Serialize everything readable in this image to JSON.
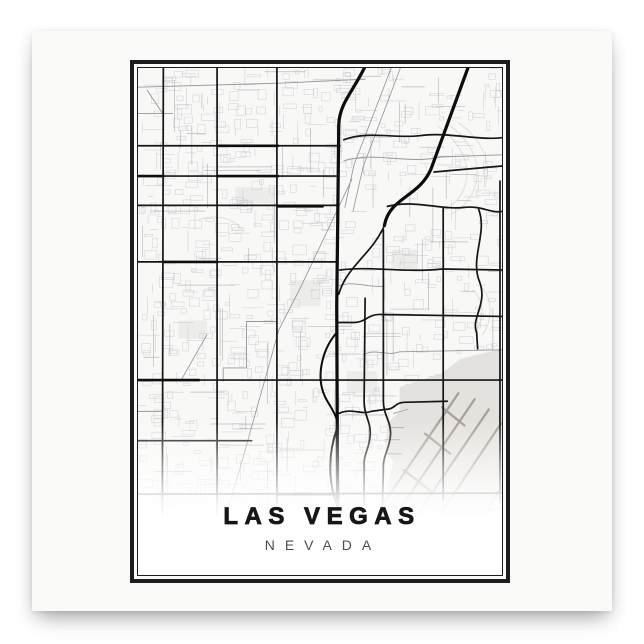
{
  "poster": {
    "title": "LAS VEGAS",
    "subtitle": "NEVADA",
    "colors": {
      "page_background": "#ffffff",
      "sheet": "#fafaf9",
      "frame": "#1d1d1f",
      "map_background": "#f8f8f6",
      "title": "#171717",
      "subtitle": "#4e4e4e",
      "road_major": "#161616",
      "road_freeway": "#0d0d0d",
      "road_medium": "#97979b",
      "road_fine": "#cdcdd1",
      "railway": "#8d8d91",
      "contour": "#d9d9d5",
      "airport_field": "#e4e2de",
      "airport_runway": "#a89f97",
      "airport_detail": "#b5afa8",
      "block_patch": "#ececea",
      "fade": "#ffffff"
    }
  },
  "map": {
    "viewbox": "0 0 359 502",
    "texture": {
      "seed": 11,
      "rect_count": 560,
      "segment_count": 300,
      "medium_segment_count": 90,
      "fine_color": "#cdcdd1",
      "medium_color": "#a7a7ac",
      "area": [
        0,
        0,
        356,
        436
      ]
    },
    "layers": [
      {
        "id": "contours",
        "stroke": "#d9d9d5",
        "width": 0.8,
        "paths": [
          "M296,58 C318,74 330,96 322,118 C318,130 308,138 300,142",
          "M306,56 C328,72 340,94 332,118 C328,131 318,140 310,144",
          "M316,54 C338,70 350,92 342,118",
          "M330,220 C344,232 340,252 332,262",
          "M338,216 C352,230 348,252 340,264",
          "M60,150 C80,144 96,150 104,162"
        ]
      },
      {
        "id": "block-patches",
        "fill": "#ececea",
        "paths": [
          "M96,118 h38 v16 h-38 Z",
          "M150,210 h30 v26 h-30 Z",
          "M250,180 h26 v20 h-26 Z",
          "M40,250 h28 v18 h-28 Z",
          "M206,300 h30 v22 h-30 Z"
        ]
      },
      {
        "id": "street-texture",
        "generate": true
      },
      {
        "id": "airport-field",
        "fill": "#e4e2de",
        "paths": [
          "M246,352 L258,340 L258,316 L300,302 L318,288 L359,278 L359,474 L268,474 L250,446 L246,414 L252,390 L244,378 Z"
        ]
      },
      {
        "id": "airport-runways",
        "stroke": "#a89f97",
        "width": 2.2,
        "paths": [
          "M252,446 L332,328",
          "M266,456 L346,338",
          "M282,466 L358,352",
          "M243,430 L316,322",
          "M300,336 L322,354",
          "M283,362 L308,382",
          "M262,398 L290,420",
          "M250,432 L276,452",
          "M244,452 L359,436",
          "M322,472 L359,414"
        ]
      },
      {
        "id": "airport-detail",
        "stroke": "#b5afa8",
        "width": 1.1,
        "paths": [
          "M248,356 L262,356",
          "M244,368 L258,368",
          "M246,382 L260,382",
          "M252,342 L266,338"
        ]
      },
      {
        "id": "railways",
        "stroke": "#8d8d91",
        "width": 0.75,
        "paths": [
          "M252,-6 L213,96 L204,138",
          "M261,-6 L222,98 L212,142",
          "M211,110 L160,218 L139,259 L99,402 L89,434",
          "M68,264 L42,310"
        ]
      },
      {
        "id": "medium-roads",
        "stroke": "#97979b",
        "width": 0.9,
        "paths": [
          "M0,19 L140,15 L224,11",
          "M0,45 L34,45",
          "M9,22 L25,46",
          "M203,92 C235,82 262,96 300,88 L359,86",
          "M197,216 C212,210 228,218 242,216",
          "M222,284 C235,277 245,286 258,281 L359,279",
          "M0,340 L24,340",
          "M241,430 L241,466",
          "M224,430 L224,462",
          "M137,251 L107,251 L107,297 L84,297 L84,310"
        ]
      },
      {
        "id": "major-roads",
        "stroke": "#161616",
        "width": 1.7,
        "paths": [
          "M25,-4 L24,450",
          "M78,-4 L78,450",
          "M137,-4 L137,432",
          "M224,228 L223,330 C223,345 230,350 229,364 C228,378 222,382 223,396 L223,432",
          "M242,160 L242,250 L242,330 C242,344 250,350 249,364 C248,378 241,384 242,398 L241,434",
          "M301,138 L301,428",
          "M357,112 L357,430",
          "M336,140 C345,164 327,188 337,212 C345,234 328,248 334,262 L335,278",
          "M0,77 L199,77",
          "M0,107 L197,107",
          "M0,136 L197,136",
          "M246,137 C272,130 300,141 322,138 C338,136 348,144 359,142",
          "M203,71 C228,62 252,70 278,67 C305,63 335,72 359,69",
          "M292,103 L359,97",
          "M0,192 L197,192",
          "M199,200 C230,196 262,203 300,199 L359,200",
          "M197,252 L213,252 C224,252 227,244 238,244 L359,246",
          "M0,309 L359,309",
          "M0,369 L112,369",
          "M198,342 C212,336 220,344 230,340 L244,338 C254,338 252,332 262,331 L305,330",
          "M0,422 L359,421",
          "M243,156 C231,184 206,196 198,224"
        ]
      },
      {
        "id": "major-emphasis",
        "stroke": "#0e0e0e",
        "width": 2.6,
        "paths": [
          "M78,77 L138,77",
          "M0,107 L25,107",
          "M78,107 L138,107",
          "M138,137 L182,137",
          "M25,192 L78,192",
          "M0,309 L60,309",
          "M138,422 L197,422"
        ]
      },
      {
        "id": "freeway-braid",
        "stroke": "#0d0d0d",
        "width": 2,
        "paths": [
          "M196,262 C182,278 178,300 181,315 C184,330 192,335 196,348",
          "M196,358 C188,380 187,408 196,432"
        ]
      },
      {
        "id": "freeways",
        "stroke": "#0d0d0d",
        "width": 3.2,
        "paths": [
          "M227,-8 C214,22 199,33 198,56 L197,150 L196,235 L197,470",
          "M329,-10 L289,100 C277,128 248,128 243,156"
        ]
      }
    ]
  }
}
